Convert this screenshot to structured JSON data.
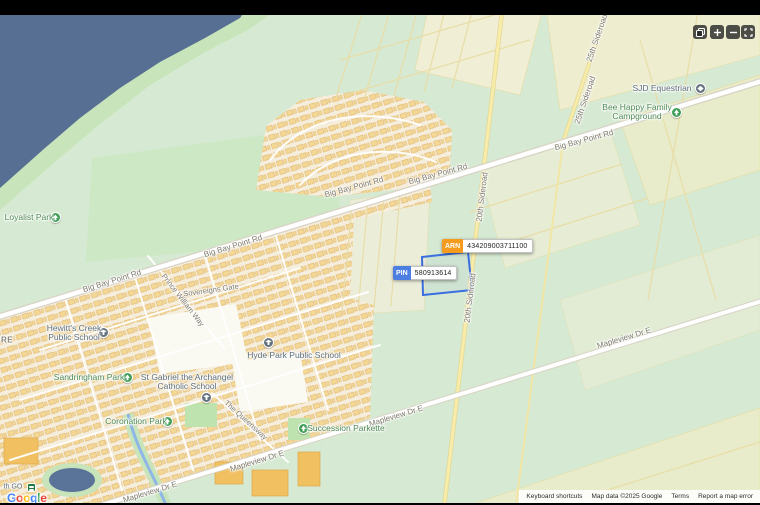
{
  "map": {
    "road_labels": [
      {
        "text": "Big Bay Point Rd"
      },
      {
        "text": "Big Bay Point Rd"
      },
      {
        "text": "Big Bay Point Rd"
      },
      {
        "text": "Big Bay Point Rd"
      },
      {
        "text": "Big Bay Point Rd"
      },
      {
        "text": "20th Sideroad"
      },
      {
        "text": "20th Sideroad"
      },
      {
        "text": "25th Sideroad"
      },
      {
        "text": "25th Sideroad"
      },
      {
        "text": "Mapleview Dr E"
      },
      {
        "text": "Mapleview Dr E"
      },
      {
        "text": "Mapleview Dr E"
      },
      {
        "text": "Mapleview Dr E"
      },
      {
        "text": "Prince William Way"
      },
      {
        "text": "Sovereigns Gate"
      },
      {
        "text": "The Queensway"
      },
      {
        "text": "RE"
      }
    ],
    "poi_labels": [
      {
        "name": "Loyalist Park",
        "type": "park"
      },
      {
        "line1": "Hewitt's Creek",
        "line2": "Public School",
        "type": "school"
      },
      {
        "name": "Sandringham Park",
        "type": "park"
      },
      {
        "name": "Hyde Park Public School",
        "type": "school"
      },
      {
        "line1": "St Gabriel the Archangel",
        "line2": "Catholic School",
        "type": "school"
      },
      {
        "name": "Coronation Park",
        "type": "park"
      },
      {
        "name": "Succession Parkette",
        "type": "park"
      },
      {
        "name": "SJD Equestrian",
        "type": "school"
      },
      {
        "line1": "Bee Happy Family",
        "line2": "Campground",
        "type": "park"
      },
      {
        "name": "th GO",
        "type": "station"
      }
    ],
    "parcel": {
      "arn_label": "ARN",
      "arn_value": "434209003711100",
      "pin_label": "PIN",
      "pin_value": "580913614"
    },
    "colors": {
      "water": "#566f93",
      "parcel_outline": "#3a6fe0",
      "arn_badge": "#f59b1e",
      "pin_badge": "#4d7fe3",
      "park_icon": "#3f9e57",
      "school_icon": "#64727d"
    }
  },
  "controls": {
    "buttons": [
      {
        "name": "screenshot"
      },
      {
        "name": "zoom-in"
      },
      {
        "name": "zoom-out"
      },
      {
        "name": "fullscreen"
      }
    ]
  },
  "footer": {
    "keyboard_shortcuts": "Keyboard shortcuts",
    "map_data": "Map data ©2025 Google",
    "terms": "Terms",
    "report_error": "Report a map error"
  },
  "logo": {
    "google_letters": [
      "G",
      "o",
      "o",
      "g",
      "l",
      "e"
    ],
    "station_text": "th GO"
  }
}
